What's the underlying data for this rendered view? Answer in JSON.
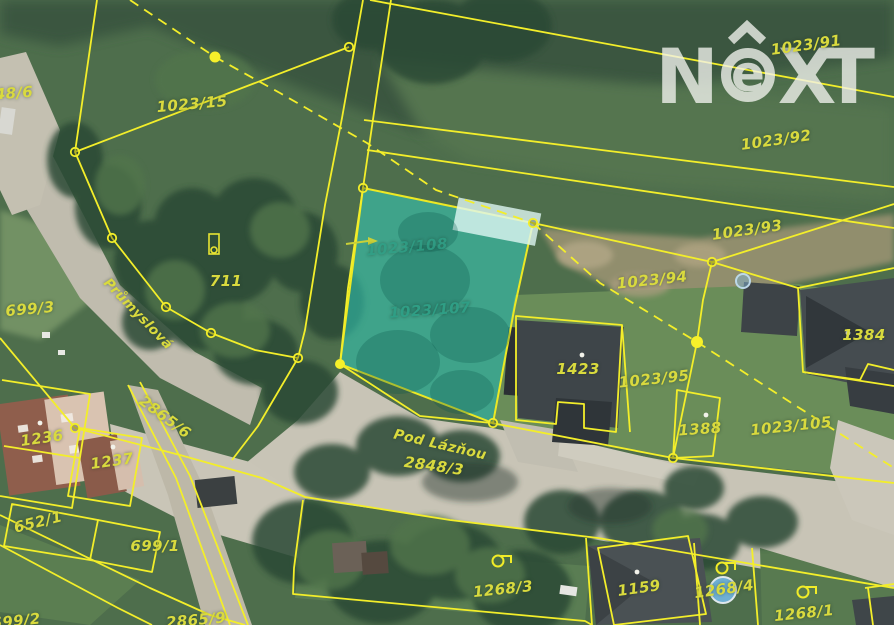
{
  "watermark": {
    "brand": "NEXT",
    "letters": {
      "n": "N",
      "e": "e",
      "x": "X",
      "t": "T"
    },
    "color": "#f2f3ee"
  },
  "map": {
    "type": "cadastral-aerial-map",
    "highlight_color": "#2fd8c8",
    "line_color": "#f3ee2a",
    "label_color": "#d9da3e",
    "teal_label_color": "#2f9e85",
    "street_names": [
      "Průmyslová",
      "Pod Lázňou"
    ],
    "highlighted_parcels": [
      "1023/108",
      "1023/107"
    ],
    "labels": [
      {
        "id": "48-6",
        "text": "48/6",
        "x": 14,
        "y": 93,
        "rot": -4
      },
      {
        "id": "1023-15",
        "text": "1023/15",
        "x": 192,
        "y": 104,
        "rot": -5
      },
      {
        "id": "1023-91",
        "text": "1023/91",
        "x": 806,
        "y": 45,
        "rot": -8
      },
      {
        "id": "1023-92",
        "text": "1023/92",
        "x": 776,
        "y": 140,
        "rot": -8
      },
      {
        "id": "1023-93",
        "text": "1023/93",
        "x": 747,
        "y": 230,
        "rot": -8
      },
      {
        "id": "1023-94",
        "text": "1023/94",
        "x": 652,
        "y": 280,
        "rot": -6
      },
      {
        "id": "1023-95",
        "text": "1023/95",
        "x": 654,
        "y": 379,
        "rot": -6
      },
      {
        "id": "711",
        "text": "711",
        "x": 226,
        "y": 281,
        "rot": 0
      },
      {
        "id": "699-3",
        "text": "699/3",
        "x": 30,
        "y": 309,
        "rot": -5
      },
      {
        "id": "prumyslova",
        "kind": "street",
        "text": "Průmyslová",
        "x": 138,
        "y": 314,
        "rot": 46,
        "size": 13.5
      },
      {
        "id": "1023-108",
        "text": "1023/108",
        "x": 407,
        "y": 247,
        "rot": -5,
        "color": "#2f9e85",
        "opacity": 0.8
      },
      {
        "id": "1023-107",
        "text": "1023/107",
        "x": 430,
        "y": 310,
        "rot": -4,
        "color": "#2f9e85"
      },
      {
        "id": "1236",
        "text": "1236",
        "x": 42,
        "y": 438,
        "rot": -8
      },
      {
        "id": "1237",
        "text": "1237",
        "x": 112,
        "y": 461,
        "rot": -8
      },
      {
        "id": "2865-6",
        "text": "2865/6",
        "x": 165,
        "y": 417,
        "rot": 37
      },
      {
        "id": "652-1",
        "text": "652/1",
        "x": 38,
        "y": 522,
        "rot": -14
      },
      {
        "id": "699-1",
        "text": "699/1",
        "x": 155,
        "y": 546,
        "rot": 0
      },
      {
        "id": "699-2",
        "text": "699/2",
        "x": 16,
        "y": 621,
        "rot": -6
      },
      {
        "id": "2865-9",
        "text": "2865/9",
        "x": 196,
        "y": 620,
        "rot": -5
      },
      {
        "id": "pod-laznou",
        "kind": "street",
        "text": "Pod Lázňou",
        "x": 440,
        "y": 445,
        "rot": 13,
        "size": 14
      },
      {
        "id": "2848-3",
        "text": "2848/3",
        "x": 434,
        "y": 466,
        "rot": 8
      },
      {
        "id": "1423",
        "text": "1423",
        "x": 578,
        "y": 369,
        "rot": 0
      },
      {
        "id": "1388",
        "text": "1388",
        "x": 700,
        "y": 429,
        "rot": -4
      },
      {
        "id": "1023-105",
        "text": "1023/105",
        "x": 791,
        "y": 426,
        "rot": -6
      },
      {
        "id": "1384",
        "text": "1384",
        "x": 864,
        "y": 335,
        "rot": 0
      },
      {
        "id": "1268-3",
        "text": "1268/3",
        "x": 503,
        "y": 589,
        "rot": -6
      },
      {
        "id": "1159",
        "text": "1159",
        "x": 639,
        "y": 588,
        "rot": -8
      },
      {
        "id": "1268-4",
        "text": "1268/4",
        "x": 724,
        "y": 589,
        "rot": -8
      },
      {
        "id": "1268-1",
        "text": "1268/1",
        "x": 804,
        "y": 613,
        "rot": -6
      }
    ]
  }
}
